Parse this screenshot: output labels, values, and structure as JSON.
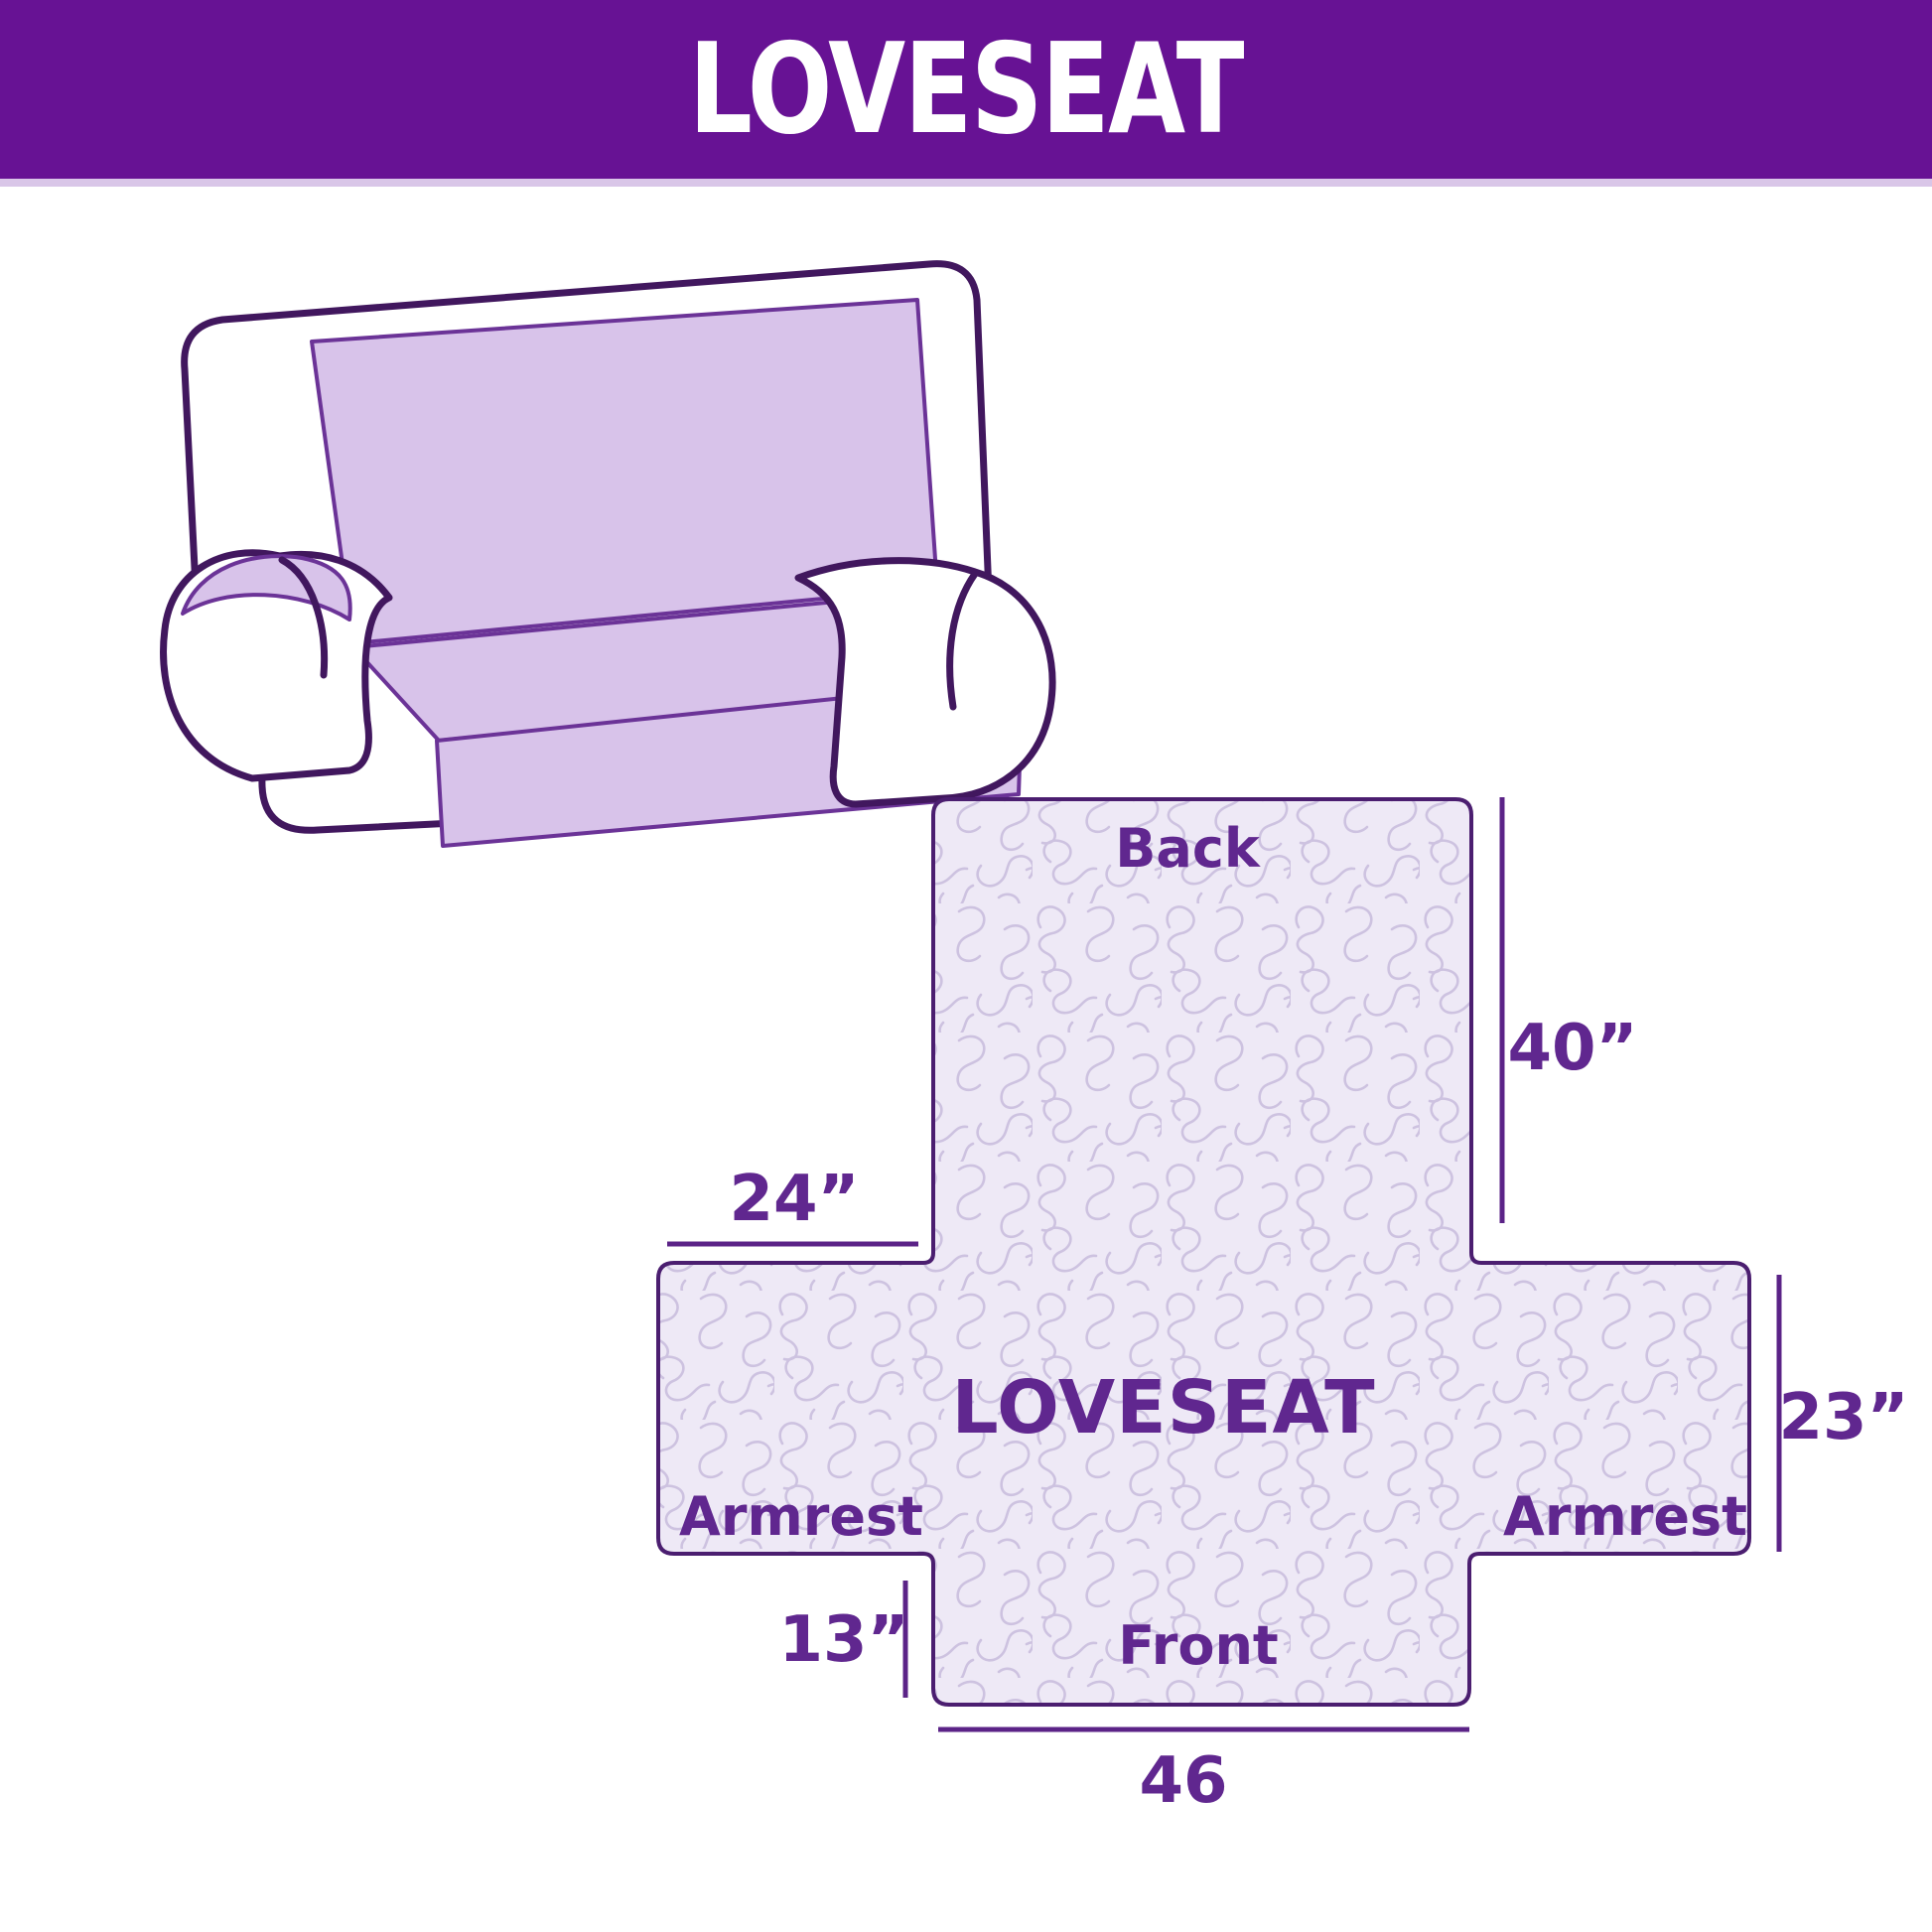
{
  "header": {
    "title": "LOVESEAT"
  },
  "illustration": {
    "name": "loveseat-sofa-line-drawing"
  },
  "cover_diagram": {
    "center_label": "LOVESEAT",
    "back_label": "Back",
    "front_label": "Front",
    "armrest_left_label": "Armrest",
    "armrest_right_label": "Armrest",
    "dimensions": {
      "back_height": "40”",
      "armrest_top_width": "24”",
      "armrest_side_height": "23”",
      "front_drop": "13”",
      "front_width": "46"
    },
    "colors": {
      "header_purple": "#671294",
      "label_purple": "#60278f",
      "dimension_line_purple": "#5b2387",
      "shape_outline_purple": "#4b1e70",
      "quilt_fill_lavender": "#eee9f6",
      "quilt_pattern_lavender": "#cdc2e0",
      "sofa_cover_lavender": "#d8c3ea",
      "sofa_outline_purple": "#41175e"
    }
  }
}
